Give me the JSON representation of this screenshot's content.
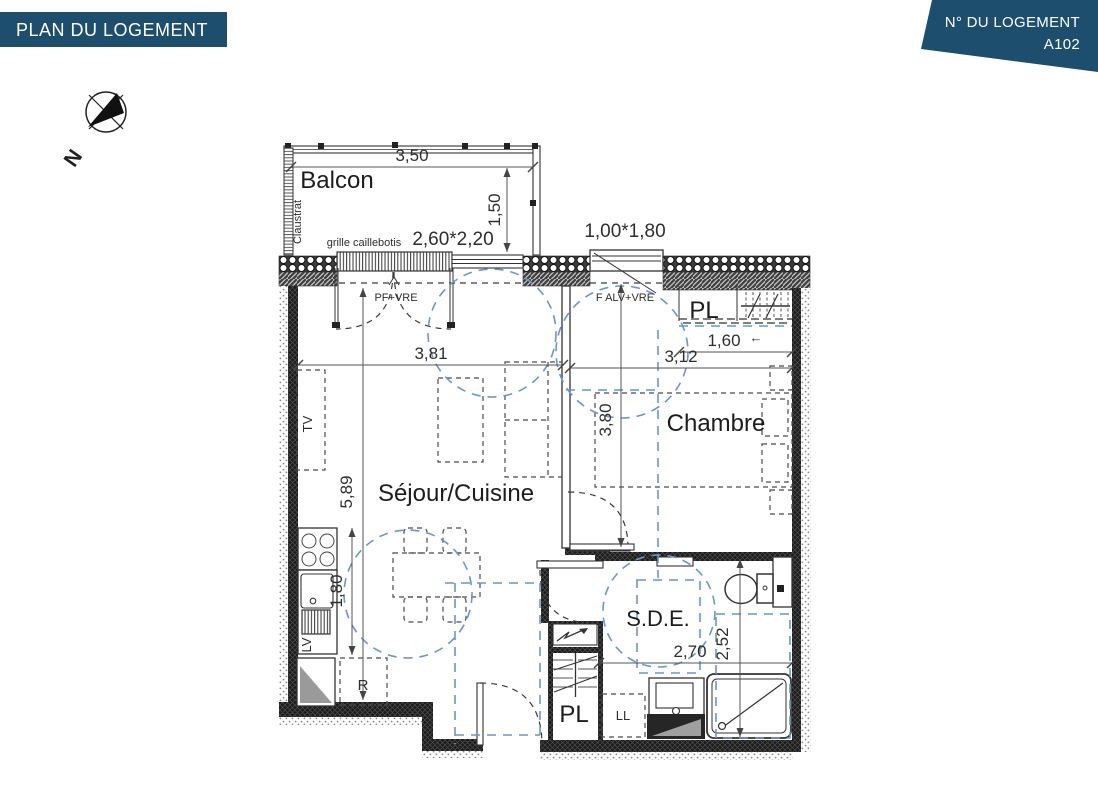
{
  "banners": {
    "left": {
      "text": "PLAN DU LOGEMENT",
      "bg": "#1d4e6d",
      "fg": "#ffffff"
    },
    "right": {
      "line1": "N° DU LOGEMENT",
      "line2": "A102",
      "bg": "#1d4e6d",
      "fg": "#ffffff"
    }
  },
  "compass": {
    "north_label": "N"
  },
  "rooms": {
    "balcon": {
      "name": "Balcon"
    },
    "sejour": {
      "name": "Séjour/Cuisine"
    },
    "chambre": {
      "name": "Chambre"
    },
    "sde": {
      "name": "S.D.E."
    },
    "pl_entry": {
      "name": "PL"
    },
    "pl_bottom": {
      "name": "PL"
    }
  },
  "annotations": {
    "claustra": "Claustrat",
    "grille": "grille caillebotis",
    "window_balcony": "2,60*2,20",
    "window_bedroom": "1,00*1,80",
    "door_balcony": "PF+VRE",
    "window_bedroom_type": "F ALV+VRE",
    "tv": "TV",
    "dishwasher": "LV",
    "fridge": "R",
    "washing_machine": "LL",
    "arrow_left": "←"
  },
  "dimensions": {
    "balcony_width": "3,50",
    "balcony_depth": "1,50",
    "living_width": "3,81",
    "living_length": "5,89",
    "kitchen_length": "1,80",
    "bedroom_width": "3,12",
    "bedroom_length": "3,80",
    "closet_width": "1,60",
    "bathroom_width": "2,70",
    "bathroom_length": "2,52"
  },
  "colors": {
    "wall": "#1c1c1c",
    "line": "#333333",
    "dimension": "#555555",
    "accessibility": "#6996cc",
    "banner": "#1d4e6d"
  }
}
